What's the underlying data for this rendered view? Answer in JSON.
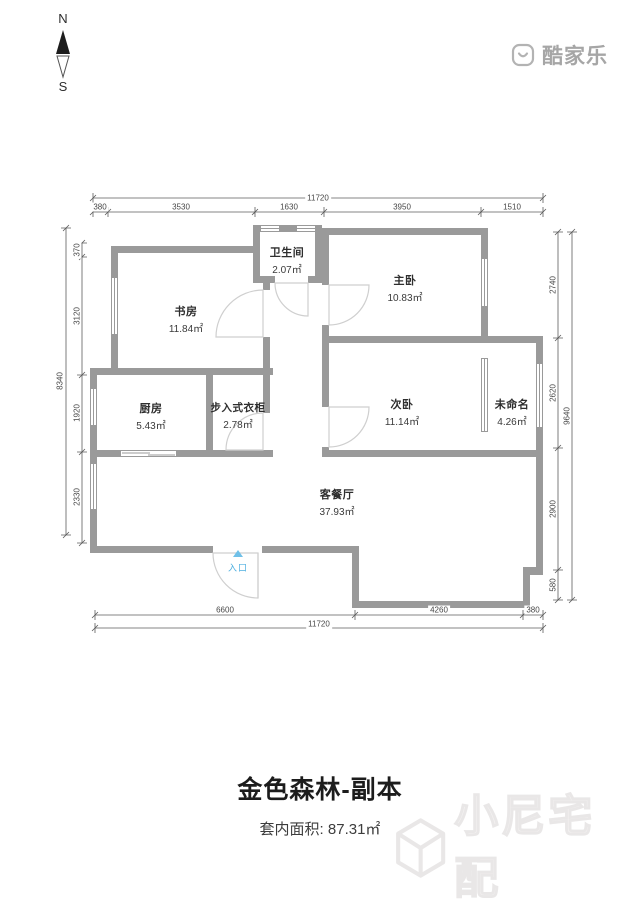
{
  "logo": {
    "text": "酷家乐"
  },
  "compass": {
    "north": "N",
    "south": "S"
  },
  "rooms": [
    {
      "name": "卫生间",
      "area": "2.07㎡"
    },
    {
      "name": "主卧",
      "area": "10.83㎡"
    },
    {
      "name": "书房",
      "area": "11.84㎡"
    },
    {
      "name": "厨房",
      "area": "5.43㎡"
    },
    {
      "name": "步入式衣柜",
      "area": "2.78㎡"
    },
    {
      "name": "次卧",
      "area": "11.14㎡"
    },
    {
      "name": "未命名",
      "area": "4.26㎡"
    },
    {
      "name": "客餐厅",
      "area": "37.93㎡"
    }
  ],
  "entrance_label": "入口",
  "dims": {
    "top_total": "11720",
    "top_segments": [
      "380",
      "3530",
      "1630",
      "3950",
      "1510"
    ],
    "bottom_total": "11720",
    "bottom_segments": [
      "6600",
      "4260",
      "380"
    ],
    "left_total": "8340",
    "left_segments": [
      "370",
      "3120",
      "1920",
      "2330"
    ],
    "right_total": "9640",
    "right_segments": [
      "2740",
      "2620",
      "2900",
      "580"
    ]
  },
  "footer": {
    "title": "金色森林-副本",
    "area_label": "套内面积:",
    "area_value": "87.31㎡"
  },
  "watermark": {
    "text": "小尼宅配"
  },
  "colors": {
    "wall": "#9a9a9a",
    "entrance_blue": "#4fb0e0",
    "dim_line": "#5c5c5c"
  }
}
